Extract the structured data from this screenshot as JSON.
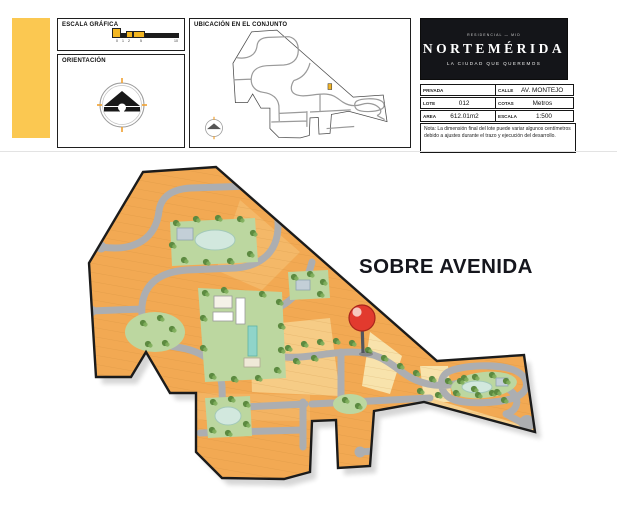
{
  "page": {
    "background": "#ffffff"
  },
  "header": {
    "accent_bar_color": "#FBC851",
    "panels": {
      "escala": {
        "title": "ESCALA GRÁFICA",
        "ticks": [
          "0",
          "1",
          "2",
          "5",
          "10"
        ]
      },
      "orientacion": {
        "title": "ORIENTACIÓN"
      },
      "ubicacion": {
        "title": "UBICACIÓN EN EL CONJUNTO"
      }
    },
    "brand": {
      "pretitle": "RESIDENCIAL — MID",
      "name": "NORTEMÉRIDA",
      "tagline": "LA CIUDAD QUE QUEREMOS",
      "bg": "#141519"
    },
    "info_table": {
      "rows": [
        {
          "label": "PRIVADA",
          "value": ""
        },
        {
          "label": "LOTE",
          "value": "012"
        },
        {
          "label": "AREA",
          "value": "612.01m2"
        },
        {
          "label": "CALLE",
          "value": "AV. MONTEJO"
        },
        {
          "label": "COTAS",
          "value": "Metros"
        },
        {
          "label": "ESCALA",
          "value": "1:500"
        }
      ],
      "note": "Nota: La dimensión final del lote puede variar algunos centímetros debido a ajustes durante el trazo y ejecución del desarrollo."
    }
  },
  "map": {
    "label": "SOBRE AVENIDA",
    "marker": "map-pin",
    "colors": {
      "lot_orange": "#F2A953",
      "lot_light": "#F6CF8C",
      "lot_pale": "#F8E3AC",
      "road": "#ACAEB1",
      "park": "#BCD7A0",
      "water": "#D2E8DE",
      "outline": "#1B1B1B",
      "pin": "#E23A2E"
    }
  }
}
